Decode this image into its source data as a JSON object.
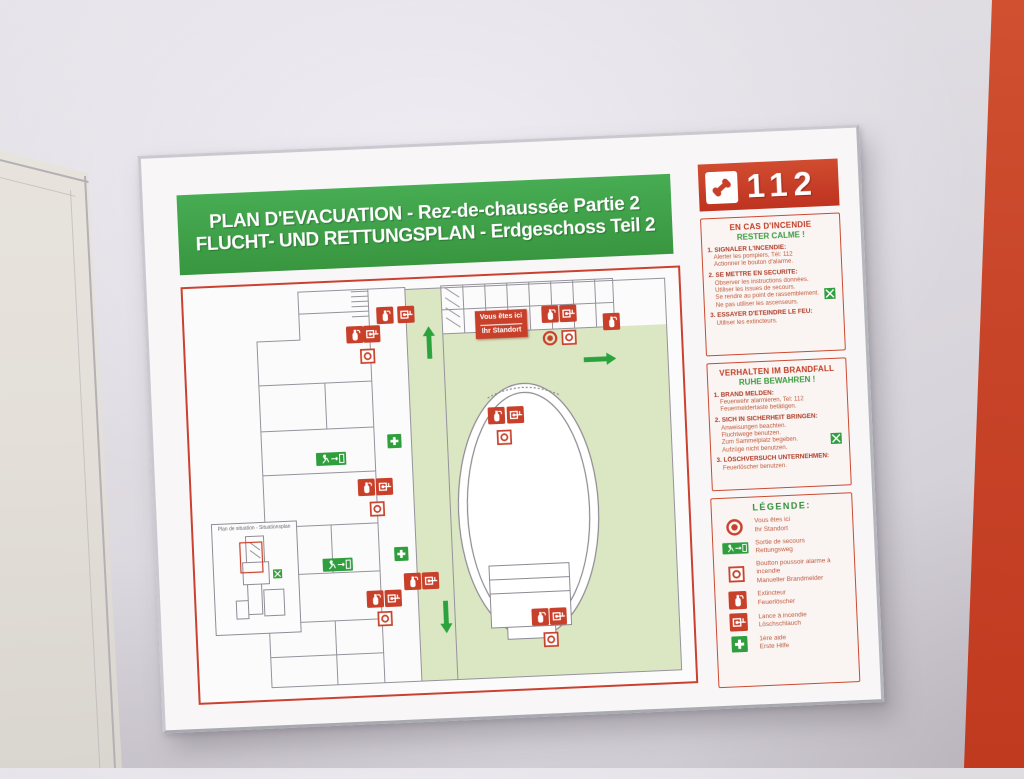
{
  "sign": {
    "title_fr": "PLAN D'EVACUATION - Rez-de-chaussée Partie 2",
    "title_de": "FLUCHT- UND RETTUNGSPLAN - Erdgeschoss Teil 2",
    "emergency_number": "112"
  },
  "panels": {
    "fr": {
      "title": "EN CAS D'INCENDIE",
      "subtitle": "RESTER CALME !",
      "items": [
        {
          "heading": "1. SIGNALER L'INCENDIE:",
          "lines": [
            "Alerter les pompiers, Tél: 112",
            "Actionner le bouton d'alarme."
          ]
        },
        {
          "heading": "2. SE METTRE EN SECURITE:",
          "lines": [
            "Observer les instructions données.",
            "Utiliser les issues de secours.",
            "Se rendre au point de rassemblement.",
            "Ne pas utiliser les ascenseurs."
          ],
          "icon": "assembly"
        },
        {
          "heading": "3. ESSAYER D'ETEINDRE LE FEU:",
          "lines": [
            "Utiliser les extincteurs."
          ]
        }
      ]
    },
    "de": {
      "title": "VERHALTEN IM BRANDFALL",
      "subtitle": "RUHE BEWAHREN !",
      "items": [
        {
          "heading": "1. BRAND MELDEN:",
          "lines": [
            "Feuerwehr alarmieren, Tel: 112",
            "Feuermeldertaste betätigen."
          ]
        },
        {
          "heading": "2. SICH IN SICHERHEIT BRINGEN:",
          "lines": [
            "Anweisungen beachten.",
            "Fluchtwege benutzen.",
            "Zum Sammelplatz begeben.",
            "Aufzüge nicht benutzen."
          ],
          "icon": "assembly"
        },
        {
          "heading": "3. LÖSCHVERSUCH UNTERNEHMEN:",
          "lines": [
            "Feuerlöscher benutzen."
          ]
        }
      ]
    }
  },
  "legend": {
    "title": "LÉGENDE:",
    "items": [
      {
        "icon": "location",
        "fr": "Vous êtes ici",
        "de": "Ihr Standort"
      },
      {
        "icon": "exit",
        "fr": "Sortie de secours",
        "de": "Rettungsweg"
      },
      {
        "icon": "alarm",
        "fr": "Boutton poussoir alarme à incendie",
        "de": "Manueller Brandmelder"
      },
      {
        "icon": "ext",
        "fr": "Extincteur",
        "de": "Feuerlöscher"
      },
      {
        "icon": "hose",
        "fr": "Lance à incendie",
        "de": "Löschschlauch"
      },
      {
        "icon": "firstaid",
        "fr": "1ère aide",
        "de": "Erste Hilfe"
      }
    ]
  },
  "plan": {
    "you_are_here": {
      "fr": "Vous êtes ici",
      "de": "Ihr Standort"
    },
    "inset_title": "Plan de situation - Situationsplan",
    "markers": [
      {
        "t": "ext",
        "x": 40.6,
        "y": 8.5
      },
      {
        "t": "hose",
        "x": 44.8,
        "y": 8.5
      },
      {
        "t": "ext",
        "x": 34.2,
        "y": 12.7
      },
      {
        "t": "hose",
        "x": 37.8,
        "y": 12.7
      },
      {
        "t": "alarm",
        "x": 36.6,
        "y": 18.2
      },
      {
        "t": "au",
        "x": 49.2,
        "y": 15.5
      },
      {
        "t": "yah",
        "x": 63.9,
        "y": 11.8
      },
      {
        "t": "ext",
        "x": 73.8,
        "y": 9.8
      },
      {
        "t": "hose",
        "x": 77.4,
        "y": 9.8
      },
      {
        "t": "location",
        "x": 73.6,
        "y": 15.8
      },
      {
        "t": "alarm",
        "x": 77.4,
        "y": 15.8
      },
      {
        "t": "ext",
        "x": 86.0,
        "y": 12.2
      },
      {
        "t": "ar",
        "x": 83.5,
        "y": 21.2
      },
      {
        "t": "ext",
        "x": 62.0,
        "y": 33.9
      },
      {
        "t": "hose",
        "x": 65.9,
        "y": 33.9
      },
      {
        "t": "alarm",
        "x": 63.6,
        "y": 39.2
      },
      {
        "t": "firstaid",
        "x": 41.3,
        "y": 39.0
      },
      {
        "t": "exit",
        "x": 28.5,
        "y": 42.4
      },
      {
        "t": "ext",
        "x": 35.2,
        "y": 49.8
      },
      {
        "t": "hose",
        "x": 38.9,
        "y": 49.8
      },
      {
        "t": "alarm",
        "x": 37.2,
        "y": 55.0
      },
      {
        "t": "firstaid",
        "x": 41.7,
        "y": 66.3
      },
      {
        "t": "exit",
        "x": 28.9,
        "y": 68.0
      },
      {
        "t": "ext",
        "x": 43.7,
        "y": 72.9
      },
      {
        "t": "hose",
        "x": 47.3,
        "y": 72.9
      },
      {
        "t": "ext",
        "x": 36.0,
        "y": 76.8
      },
      {
        "t": "hose",
        "x": 39.7,
        "y": 76.8
      },
      {
        "t": "alarm",
        "x": 38.0,
        "y": 81.6
      },
      {
        "t": "ad",
        "x": 50.2,
        "y": 82.0
      },
      {
        "t": "ext",
        "x": 69.1,
        "y": 82.9
      },
      {
        "t": "hose",
        "x": 72.8,
        "y": 82.9
      },
      {
        "t": "alarm",
        "x": 71.1,
        "y": 88.3
      }
    ]
  },
  "colors": {
    "header_green": "#3ea44b",
    "safety_red": "#c8402a",
    "plan_area_green": "#dbe7c3",
    "arrow_green": "#2aa33c",
    "panel_text": "#bf5a3c",
    "accent_wall_orange": "#c84429",
    "wall_gray": "#dfdce2"
  }
}
